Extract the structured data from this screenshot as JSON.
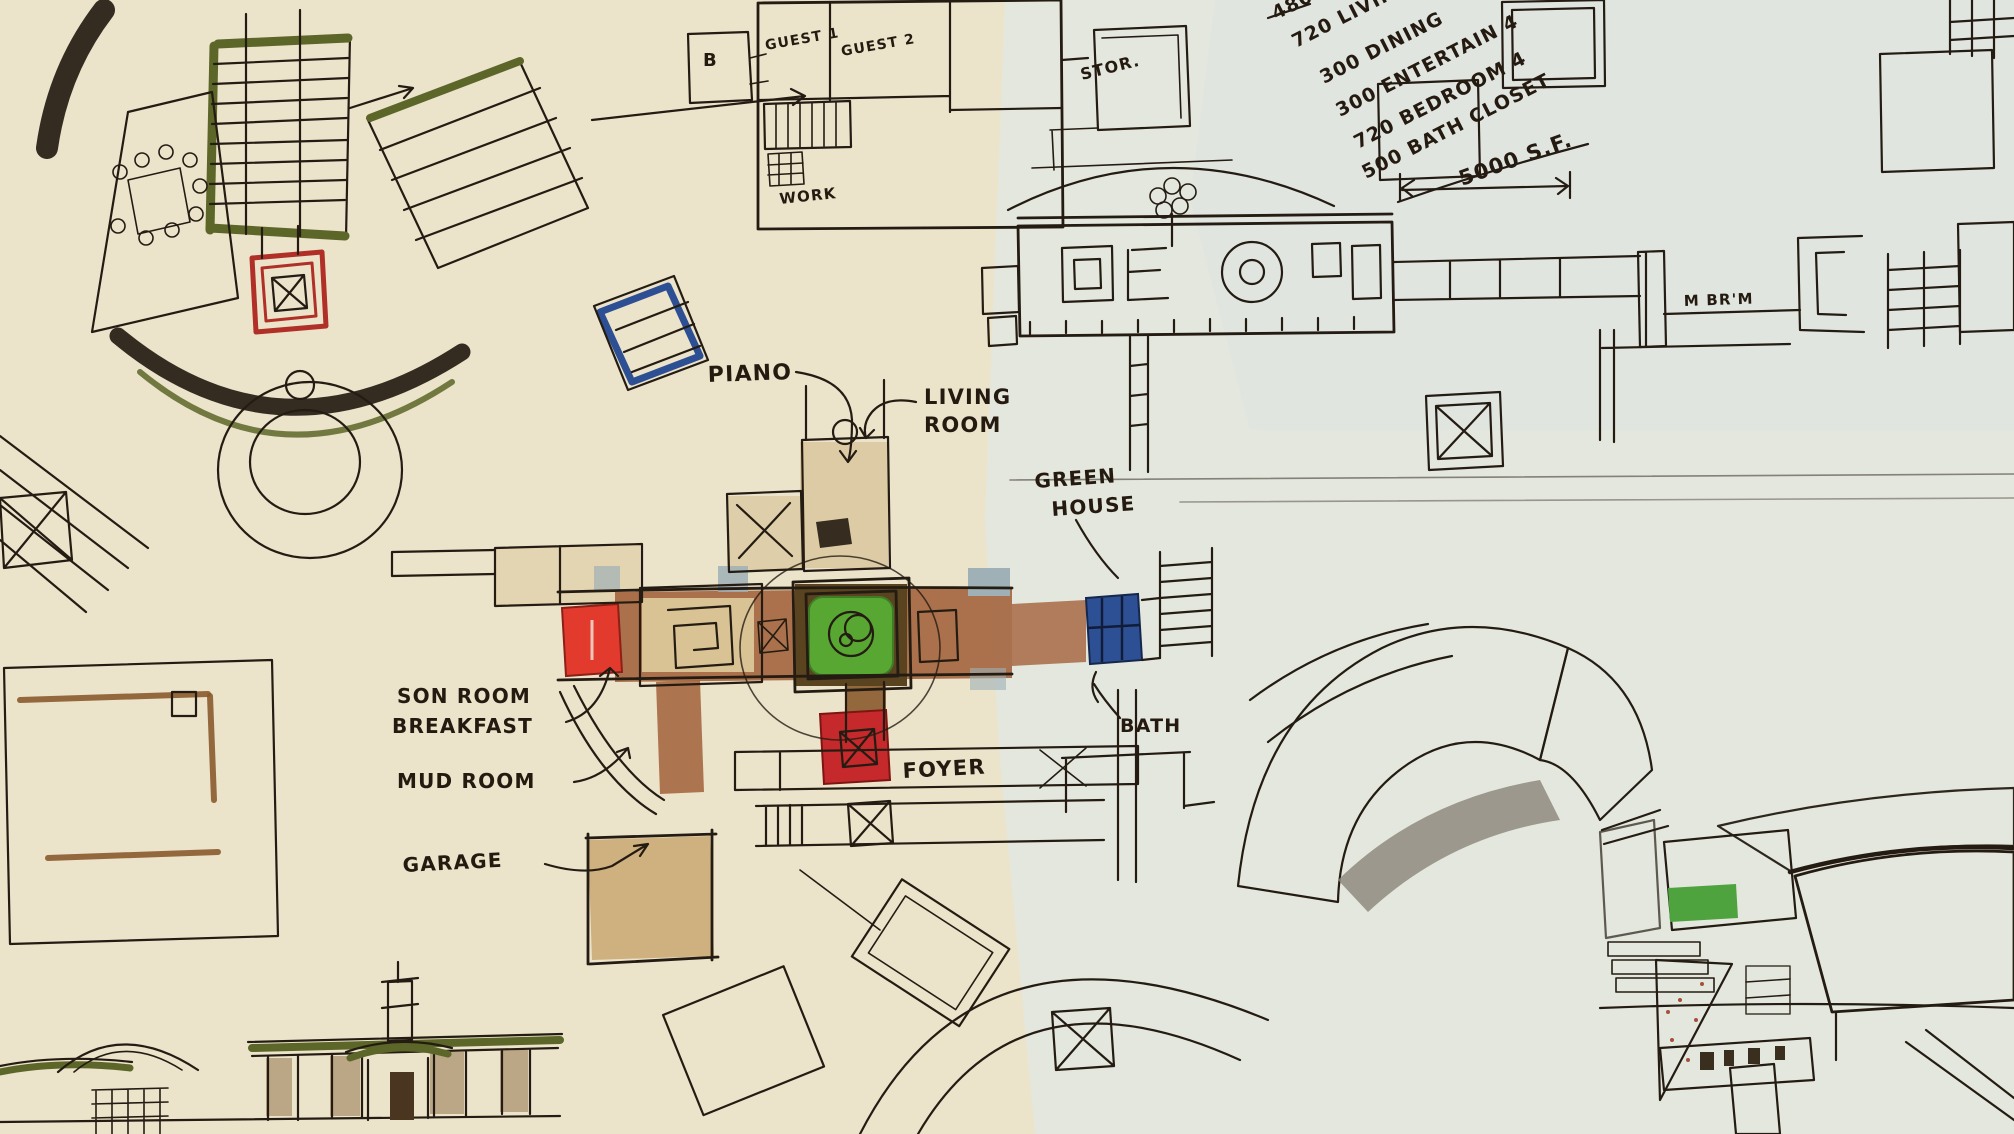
{
  "palette": {
    "paper_left": "#ece3cb",
    "paper_right": "#e4e7de",
    "paper_top_right": "#dfe4e1",
    "ink": "#241c12",
    "marker_brown": "#a2613a",
    "marker_dark_brown": "#5a4420",
    "marker_tan": "#d9c294",
    "marker_olive": "#5c6628",
    "marker_red": "#e23b2d",
    "marker_crimson": "#c5292b",
    "marker_green": "#58a733",
    "marker_blue": "#2d4f93",
    "marker_slate": "#9fb0b6",
    "marker_salmon": "#dba28c",
    "marker_gray": "#8b8578",
    "marker_pool": "#b9cfc4"
  },
  "program_notes": {
    "items": [
      "480 MU",
      "720 LIVING",
      "300 DINING",
      "300 ENTERTAIN 4",
      "720 BEDROOM 4",
      "500 BATH CLOSET"
    ],
    "total": "5000 S.F."
  },
  "room_labels": {
    "b": "B",
    "guest1": "GUEST 1",
    "guest2": "GUEST 2",
    "work": "WORK",
    "stor": "STOR.",
    "piano": "PIANO",
    "living_room_line1": "LIVING",
    "living_room_line2": "ROOM",
    "green_house_line1": "GREEN",
    "green_house_line2": "HOUSE",
    "bath": "BATH",
    "foyer": "FOYER",
    "son_room": "SON ROOM",
    "breakfast": "BREAKFAST",
    "mud_room": "MUD ROOM",
    "garage": "GARAGE",
    "master_bedroom": "M BR'M"
  }
}
